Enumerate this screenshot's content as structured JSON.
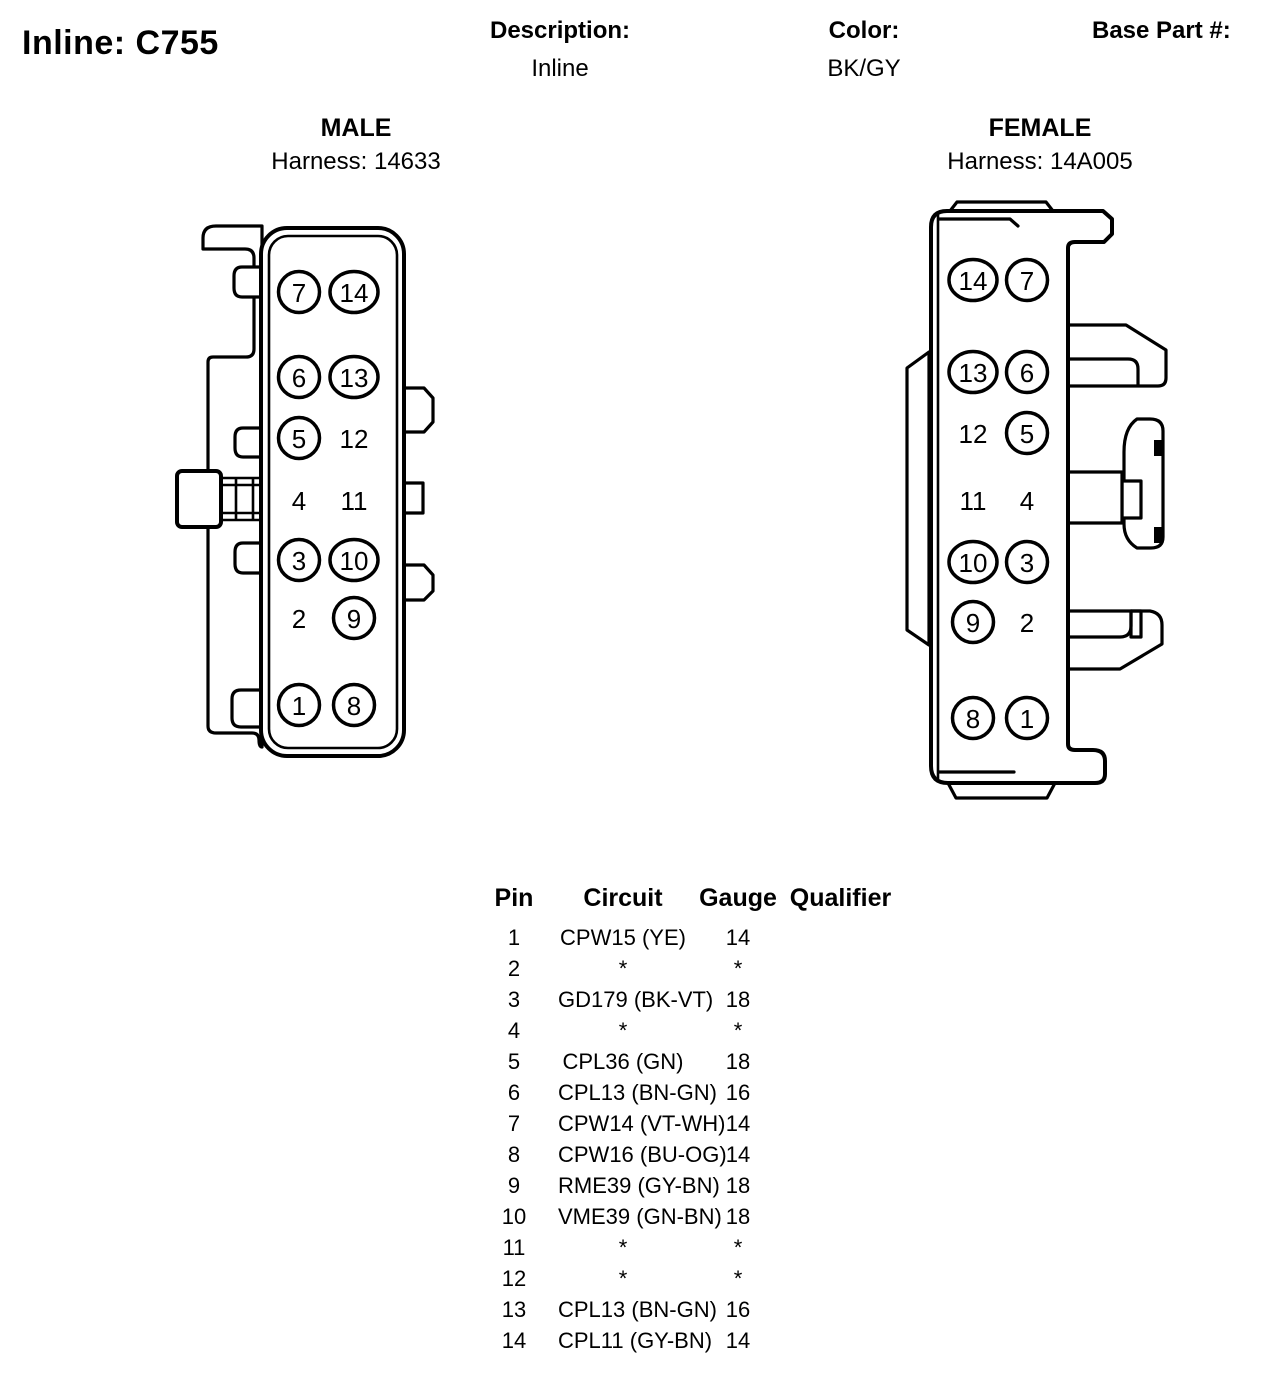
{
  "header": {
    "title": "Inline: C755",
    "description_label": "Description:",
    "description_value": "Inline",
    "color_label": "Color:",
    "color_value": "BK/GY",
    "base_part_label": "Base Part #:"
  },
  "connectors": {
    "male": {
      "title": "MALE",
      "harness": "Harness: 14633",
      "pin_rows": [
        {
          "left": "7",
          "left_circled": true,
          "right": "14",
          "right_circled": true
        },
        {
          "left": "6",
          "left_circled": true,
          "right": "13",
          "right_circled": true
        },
        {
          "left": "5",
          "left_circled": true,
          "right": "12",
          "right_circled": false
        },
        {
          "left": "4",
          "left_circled": false,
          "right": "11",
          "right_circled": false
        },
        {
          "left": "3",
          "left_circled": true,
          "right": "10",
          "right_circled": true
        },
        {
          "left": "2",
          "left_circled": false,
          "right": "9",
          "right_circled": true
        },
        {
          "left": "1",
          "left_circled": true,
          "right": "8",
          "right_circled": true
        }
      ]
    },
    "female": {
      "title": "FEMALE",
      "harness": "Harness: 14A005",
      "pin_rows": [
        {
          "left": "14",
          "left_circled": true,
          "right": "7",
          "right_circled": true
        },
        {
          "left": "13",
          "left_circled": true,
          "right": "6",
          "right_circled": true
        },
        {
          "left": "12",
          "left_circled": false,
          "right": "5",
          "right_circled": true
        },
        {
          "left": "11",
          "left_circled": false,
          "right": "4",
          "right_circled": false
        },
        {
          "left": "10",
          "left_circled": true,
          "right": "3",
          "right_circled": true
        },
        {
          "left": "9",
          "left_circled": true,
          "right": "2",
          "right_circled": false
        },
        {
          "left": "8",
          "left_circled": true,
          "right": "1",
          "right_circled": true
        }
      ]
    }
  },
  "table": {
    "headers": [
      "Pin",
      "Circuit",
      "Gauge",
      "Qualifier"
    ],
    "rows": [
      {
        "pin": "1",
        "circuit": "CPW15 (YE)",
        "gauge": "14",
        "qualifier": ""
      },
      {
        "pin": "2",
        "circuit": "*",
        "gauge": "*",
        "qualifier": ""
      },
      {
        "pin": "3",
        "circuit": "GD179 (BK-VT)",
        "gauge": "18",
        "qualifier": ""
      },
      {
        "pin": "4",
        "circuit": "*",
        "gauge": "*",
        "qualifier": ""
      },
      {
        "pin": "5",
        "circuit": "CPL36 (GN)",
        "gauge": "18",
        "qualifier": ""
      },
      {
        "pin": "6",
        "circuit": "CPL13 (BN-GN)",
        "gauge": "16",
        "qualifier": ""
      },
      {
        "pin": "7",
        "circuit": "CPW14 (VT-WH)",
        "gauge": "14",
        "qualifier": ""
      },
      {
        "pin": "8",
        "circuit": "CPW16 (BU-OG)",
        "gauge": "14",
        "qualifier": ""
      },
      {
        "pin": "9",
        "circuit": "RME39 (GY-BN)",
        "gauge": "18",
        "qualifier": ""
      },
      {
        "pin": "10",
        "circuit": "VME39 (GN-BN)",
        "gauge": "18",
        "qualifier": ""
      },
      {
        "pin": "11",
        "circuit": "*",
        "gauge": "*",
        "qualifier": ""
      },
      {
        "pin": "12",
        "circuit": "*",
        "gauge": "*",
        "qualifier": ""
      },
      {
        "pin": "13",
        "circuit": "CPL13 (BN-GN)",
        "gauge": "16",
        "qualifier": ""
      },
      {
        "pin": "14",
        "circuit": "CPL11 (GY-BN)",
        "gauge": "14",
        "qualifier": ""
      }
    ]
  }
}
